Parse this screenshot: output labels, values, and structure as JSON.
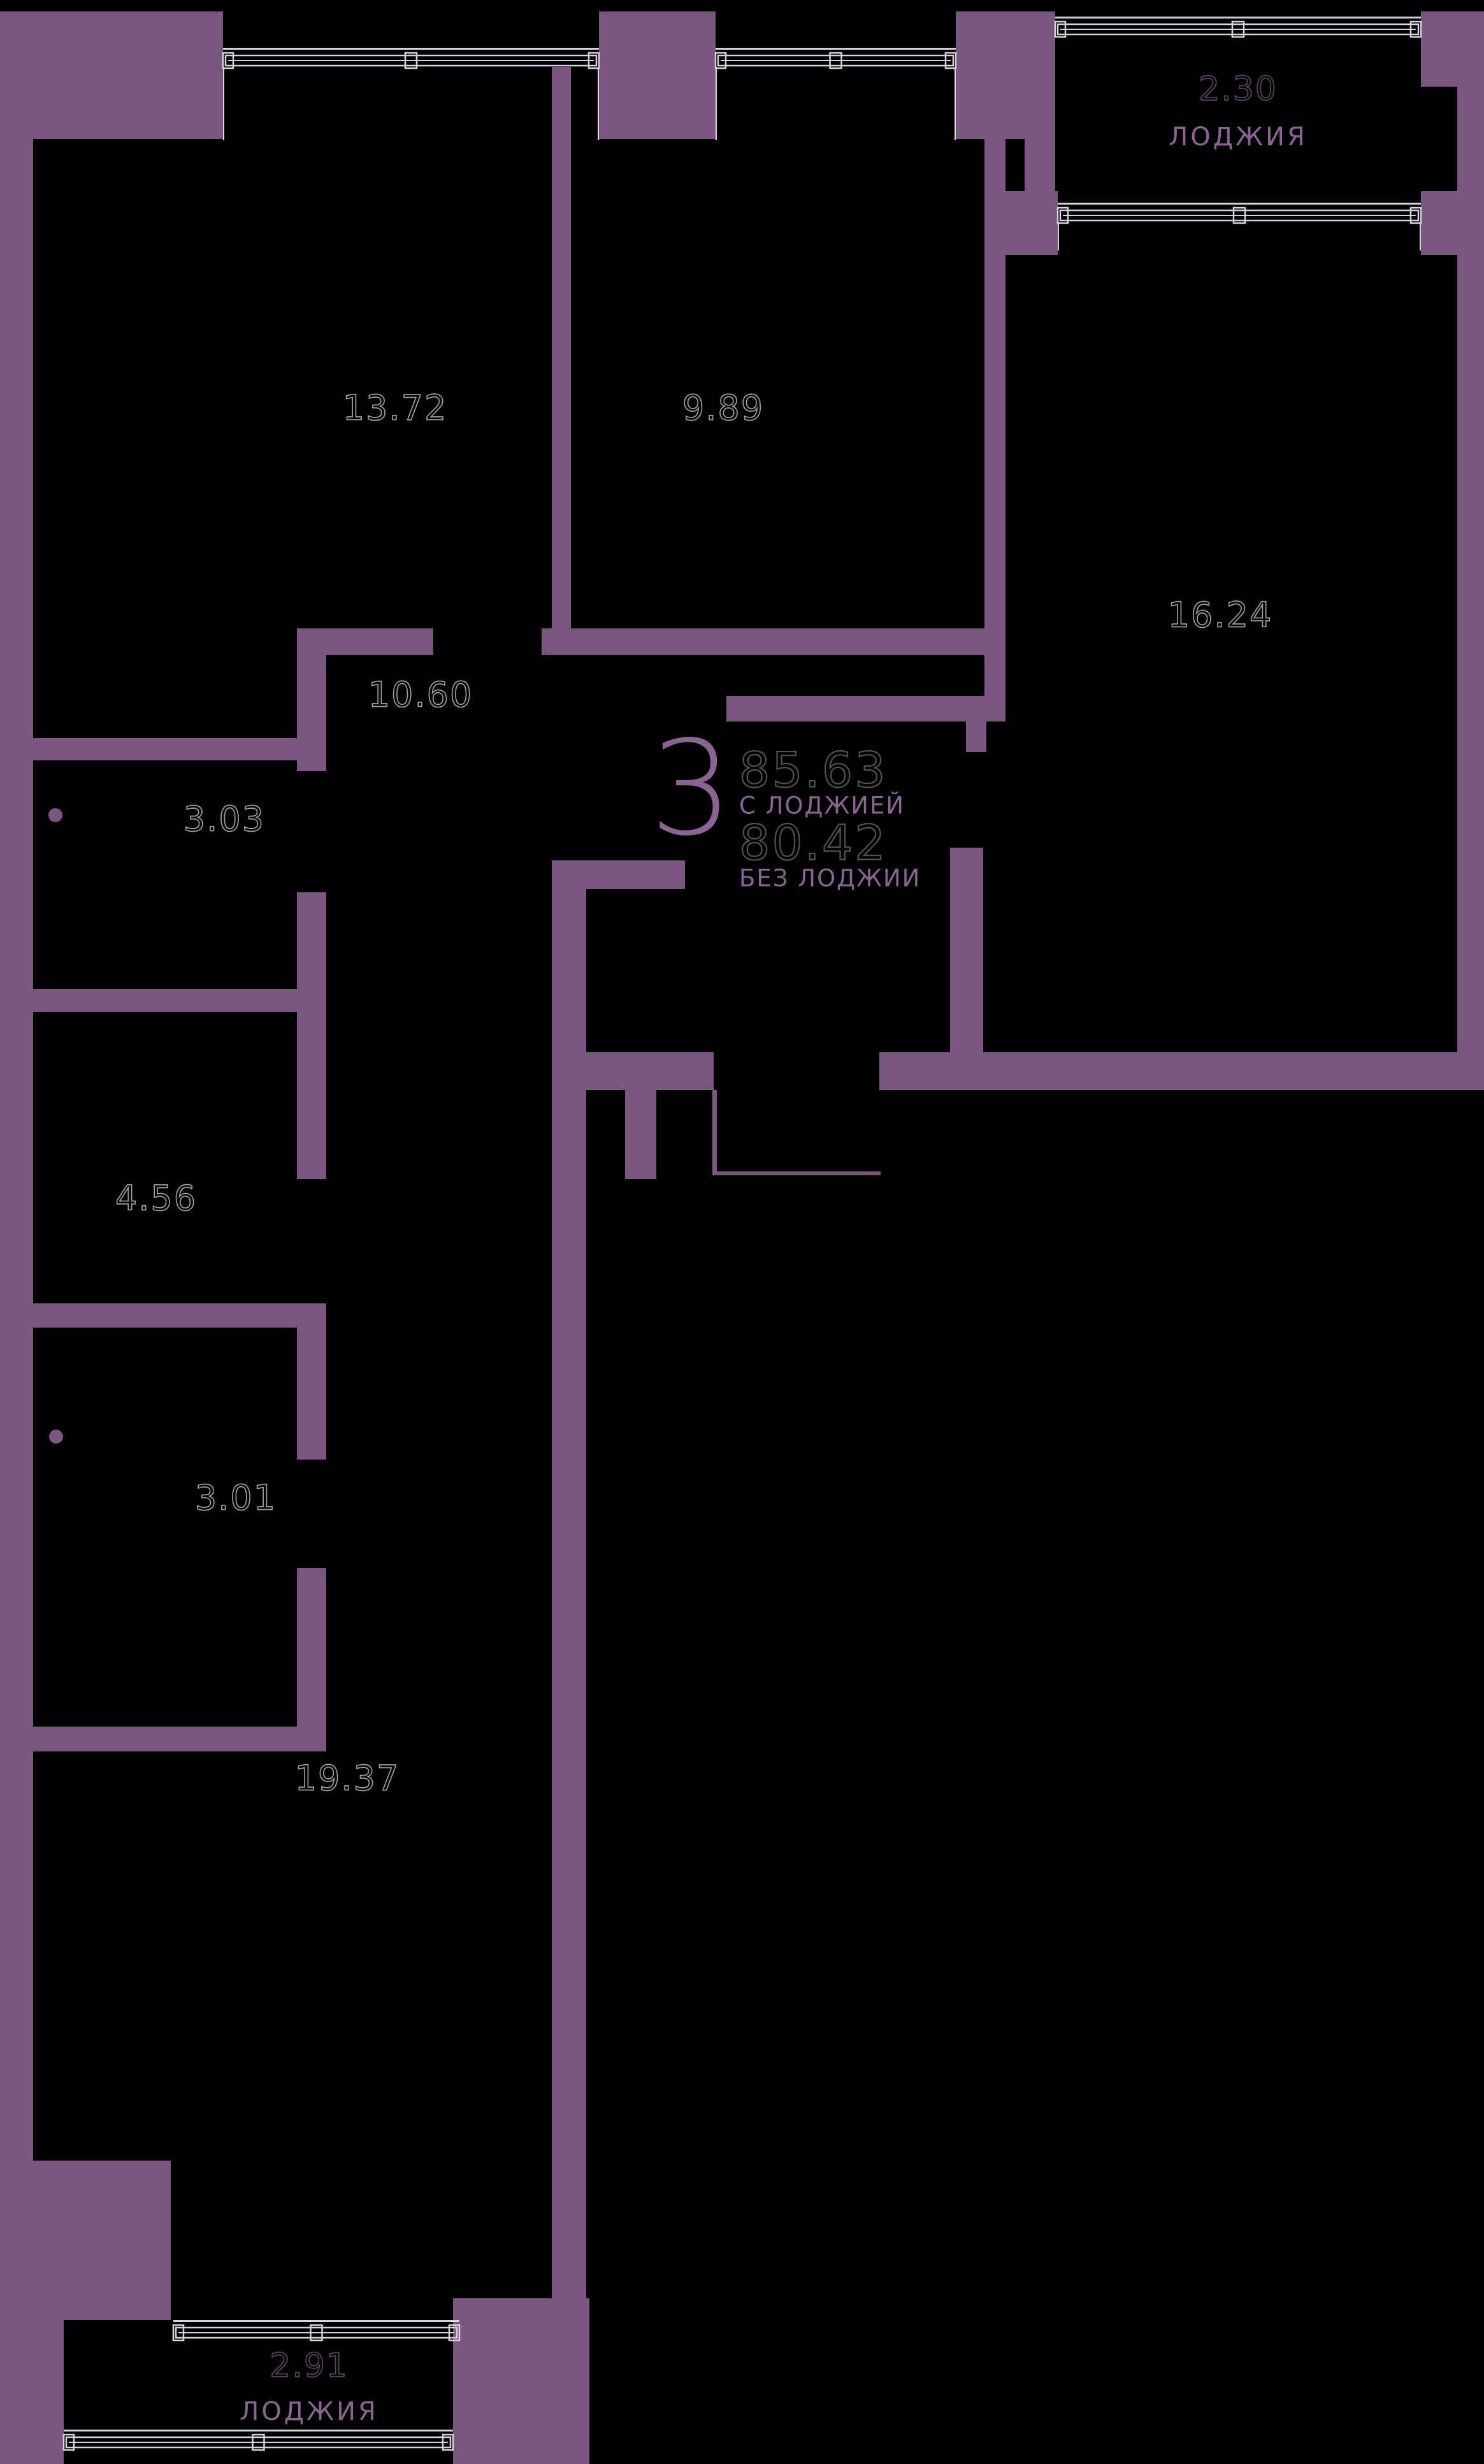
{
  "plan": {
    "unit": {
      "number": "3",
      "area_with_loggia": "85.63",
      "with_loggia_label": "С ЛОДЖИЕЙ",
      "area_without_loggia": "80.42",
      "without_loggia_label": "БЕЗ ЛОДЖИИ"
    },
    "rooms": [
      {
        "id": "room-13-72",
        "area": "13.72"
      },
      {
        "id": "room-9-89",
        "area": "9.89"
      },
      {
        "id": "room-16-24",
        "area": "16.24"
      },
      {
        "id": "hall-10-60",
        "area": "10.60"
      },
      {
        "id": "room-3-03",
        "area": "3.03"
      },
      {
        "id": "room-4-56",
        "area": "4.56"
      },
      {
        "id": "room-3-01",
        "area": "3.01"
      },
      {
        "id": "room-19-37",
        "area": "19.37"
      }
    ],
    "loggias": [
      {
        "id": "loggia-top",
        "area": "2.30",
        "label": "ЛОДЖИЯ"
      },
      {
        "id": "loggia-bottom",
        "area": "2.91",
        "label": "ЛОДЖИЯ"
      }
    ],
    "colors": {
      "wall": "#7a577f",
      "accent_text": "#8a6492",
      "room_number_outline": "#9e9e9e",
      "area_number_outline": "#525252",
      "loggia_number_outline": "#5e4565",
      "window_line": "#d8d2dc",
      "background": "#000000"
    }
  }
}
